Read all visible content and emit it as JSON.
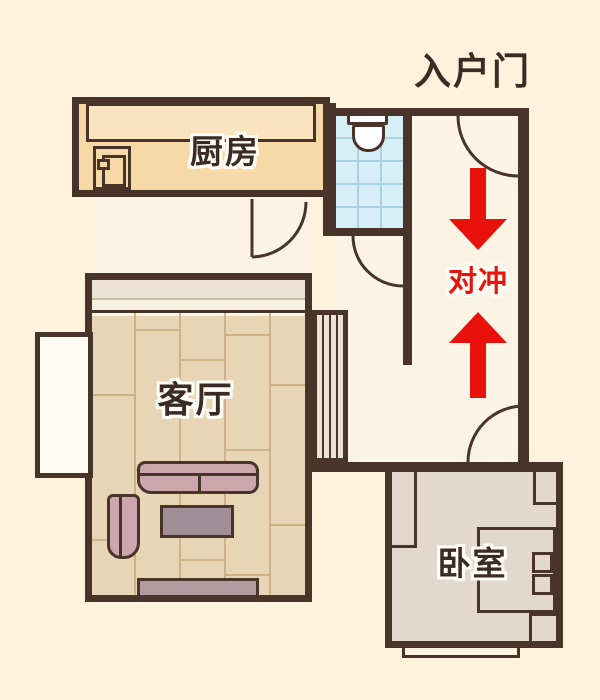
{
  "title": "apartment-floor-plan",
  "labels": {
    "entrance_door": "入户门",
    "kitchen": "厨房",
    "living_room": "客厅",
    "bedroom": "卧室",
    "clash": "对冲"
  },
  "annotation": {
    "clash_text": "对冲",
    "arrow_directions": [
      "down",
      "up"
    ],
    "accent_color": "#e8120b"
  },
  "colors": {
    "background": "#fdf2dc",
    "room_interior": "#fbf4e5",
    "wall": "#483428",
    "kitchen_fill": "#f7d9a7",
    "counter_fill": "#f9e4bd",
    "bathroom_fill": "#d6eef8",
    "living_floor": "#e7d5b5",
    "bedroom_floor": "#e2d8cd",
    "sofa_fill": "#cba6ad",
    "table_fill": "#a28e97",
    "accent_red": "#e8120b",
    "label_text": "#3c2b24"
  },
  "icons": {
    "toilet": "toilet-icon",
    "fridge": "fridge-icon",
    "door_swing": "door-swing-icon",
    "arrow_down": "arrow-down-icon",
    "arrow_up": "arrow-up-icon"
  }
}
